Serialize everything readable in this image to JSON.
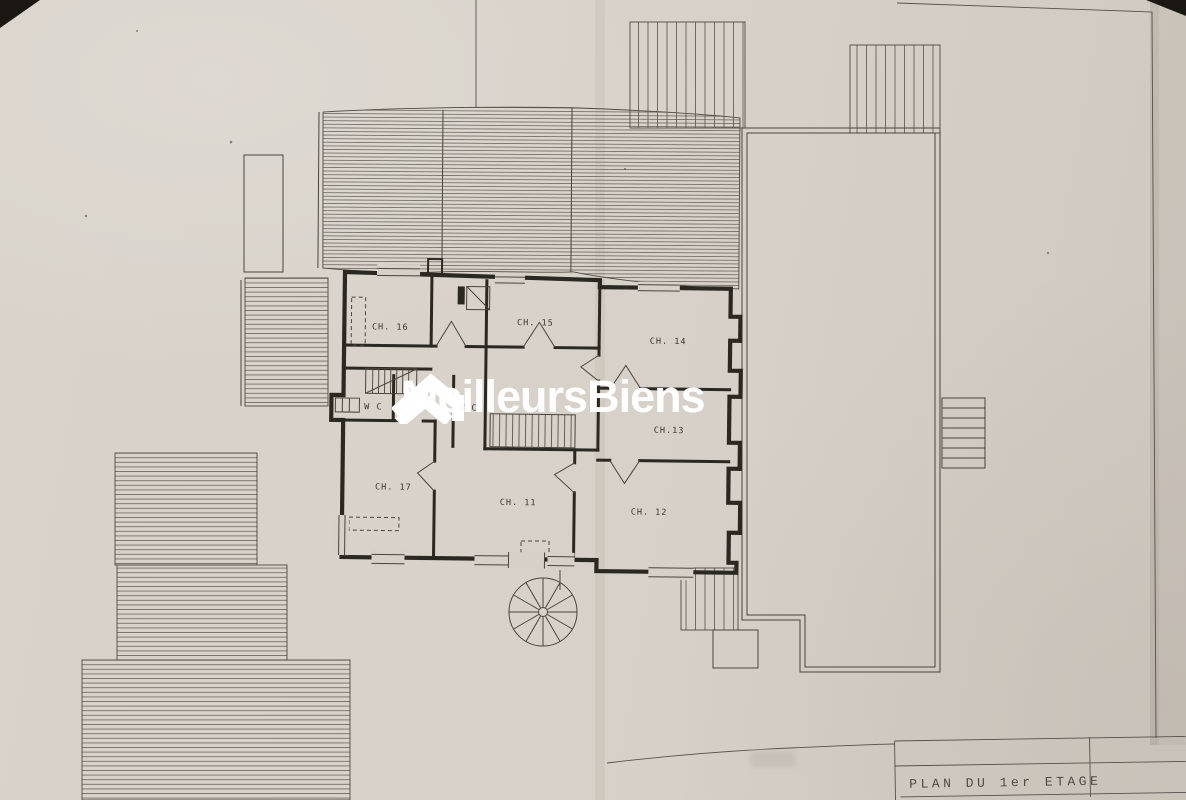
{
  "document": {
    "type_label": "PLAN DU 1er ETAGE"
  },
  "watermark": {
    "brand": "MeilleursBiens"
  },
  "rooms": [
    {
      "id": "ch16",
      "label": "CH. 16"
    },
    {
      "id": "ch15",
      "label": "CH. 15"
    },
    {
      "id": "ch14",
      "label": "CH. 14"
    },
    {
      "id": "ch13",
      "label": "CH.13"
    },
    {
      "id": "ch17",
      "label": "CH. 17"
    },
    {
      "id": "ch11",
      "label": "CH. 11"
    },
    {
      "id": "ch12",
      "label": "CH. 12"
    },
    {
      "id": "wc_left",
      "label": "W C"
    },
    {
      "id": "wc_right",
      "label": "W C"
    }
  ],
  "colors": {
    "paper": "#d6d0c8",
    "ink": "#46413a",
    "wall": "#2b2721",
    "watermark": "#ffffff"
  }
}
